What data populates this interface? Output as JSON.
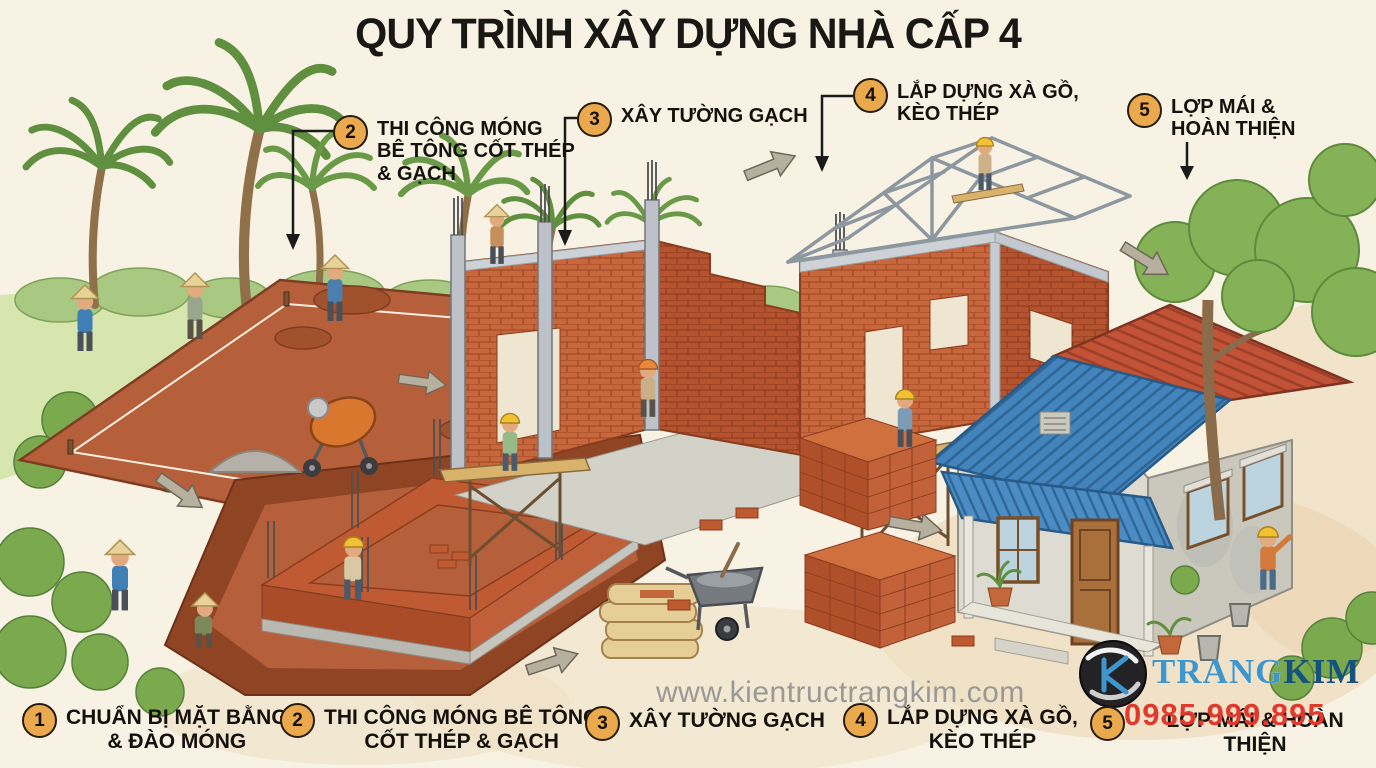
{
  "title": "QUY TRÌNH XÂY DỰNG NHÀ CẤP 4",
  "watermark": "www.kientructrangkim.com",
  "phone": "0985.999.895",
  "logo": {
    "part1": "TRANG",
    "part2": "KIM"
  },
  "top_callouts": [
    {
      "number": "2",
      "label": "THI CÔNG MÓNG\nBÊ TÔNG CỐT THÉP\n& GẠCH"
    },
    {
      "number": "3",
      "label": "XÂY TƯỜNG GẠCH"
    },
    {
      "number": "4",
      "label": "LẮP DỰNG XÀ GỒ,\nKÈO THÉP"
    },
    {
      "number": "5",
      "label": "LỢP MÁI &\nHOÀN THIỆN"
    }
  ],
  "legend": [
    {
      "number": "1",
      "label": "CHUẨN BỊ MẶT BẰNG\n& ĐÀO MÓNG"
    },
    {
      "number": "2",
      "label": "THI CÔNG MÓNG BÊ TÔNG\nCỐT THÉP & GẠCH"
    },
    {
      "number": "3",
      "label": "XÂY TƯỜNG GẠCH"
    },
    {
      "number": "4",
      "label": "LẮP DỰNG XÀ GỒ,\nKÈO THÉP"
    },
    {
      "number": "5",
      "label": "LỢP MÁI & HOÀN THIỆN"
    }
  ],
  "colors": {
    "bg": "#f7f2e3",
    "ink": "#1a1815",
    "accent": "#eba94d",
    "brick": "#c05a32",
    "roof_blue": "#4384bd",
    "roof_red": "#c25337",
    "steel": "#8d97a0",
    "phone": "#e0392e",
    "wm": "#8f8f8f",
    "lb1": "#3e96cc",
    "lb2": "#15527d"
  },
  "scene": {
    "stage_icons": [
      "site-clearing-excavation-scene",
      "brick-foundation-pit-scene",
      "brick-walls-scaffolding-scene",
      "steel-roof-truss-scene",
      "finished-house-scene"
    ]
  }
}
